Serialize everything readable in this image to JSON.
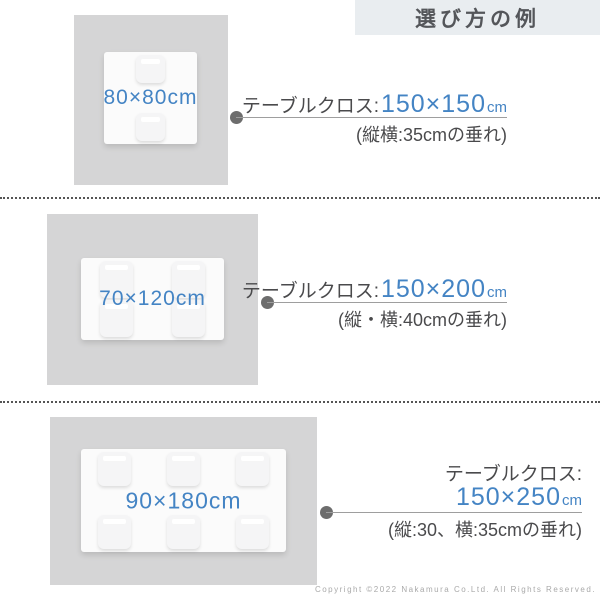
{
  "header": {
    "title": "選び方の例"
  },
  "sections": [
    {
      "table_label": "80×80cm",
      "cloth_label": "テーブルクロス:",
      "cloth_size": "150×150",
      "cloth_unit": "cm",
      "note": "(縦横:35cmの垂れ)"
    },
    {
      "table_label": "70×120cm",
      "cloth_label": "テーブルクロス:",
      "cloth_size": "150×200",
      "cloth_unit": "cm",
      "note": "(縦・横:40cmの垂れ)"
    },
    {
      "table_label": "90×180cm",
      "cloth_label": "テーブルクロス:",
      "cloth_size": "150×250",
      "cloth_unit": "cm",
      "note": "(縦:30、横:35cmの垂れ)"
    }
  ],
  "footer": {
    "copyright": "Copyright ©2022 Nakamura Co.Ltd. All Rights Reserved."
  },
  "colors": {
    "accent_blue": "#4484c4",
    "text_dark": "#4a4a4c",
    "cloth_gray": "#d5d5d6",
    "header_bg": "#e9edf0"
  }
}
